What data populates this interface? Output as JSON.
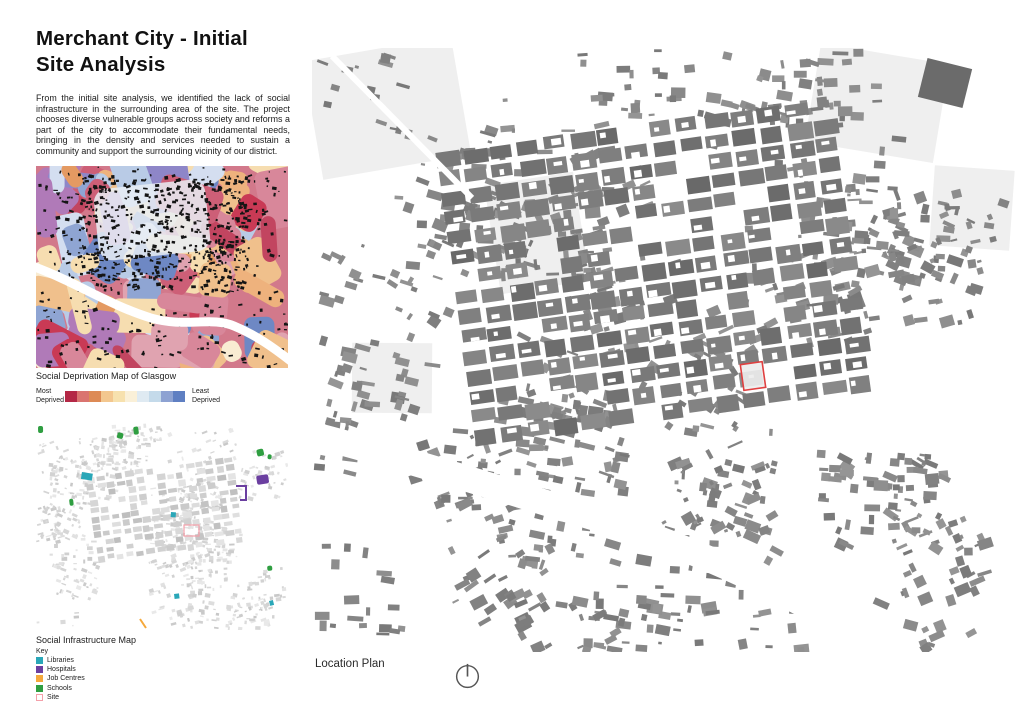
{
  "header": {
    "title": "Merchant City - Initial\nSite Analysis",
    "intro": "From the initial site analysis, we identified the lack of social infrastructure in the surrounding area of the site. The project chooses diverse vulnerable groups across society and reforms a part of the city to accommodate their fundamental needs, bringing in the density and services needed to sustain a community and support the surrounding vicinity of our district."
  },
  "deprivation_map": {
    "caption": "Social Deprivation Map of Glasgow",
    "legend": {
      "left_label": "Most\nDeprived",
      "right_label": "Least\nDeprived",
      "colors": [
        "#b42846",
        "#da7470",
        "#dd8a55",
        "#f3c78f",
        "#f7e1ae",
        "#faf0d8",
        "#dfeaf2",
        "#c4daea",
        "#8da2d2",
        "#5f7fc2"
      ]
    }
  },
  "infrastructure_map": {
    "caption": "Social Infrastructure Map",
    "key_title": "Key",
    "key": [
      {
        "type": "library",
        "label": "Libraries",
        "color": "#2aa7b8",
        "filled": true
      },
      {
        "type": "hospital",
        "label": "Hospitals",
        "color": "#6b3fa0",
        "filled": true
      },
      {
        "type": "jobcentre",
        "label": "Job Centres",
        "color": "#f5a93c",
        "filled": true
      },
      {
        "type": "school",
        "label": "Schools",
        "color": "#2f9e41",
        "filled": true
      },
      {
        "type": "site",
        "label": "Site",
        "color": "#f4a0aa",
        "filled": false
      }
    ],
    "markers": [
      {
        "type": "school",
        "shape": "blob",
        "x": 2,
        "y": 6,
        "w": 5,
        "h": 7
      },
      {
        "type": "school",
        "shape": "blob",
        "x": 82,
        "y": 12,
        "w": 6,
        "h": 6
      },
      {
        "type": "school",
        "shape": "blob",
        "x": 97,
        "y": 7,
        "w": 5,
        "h": 8
      },
      {
        "type": "school",
        "shape": "blob",
        "x": 220,
        "y": 30,
        "w": 7,
        "h": 7
      },
      {
        "type": "school",
        "shape": "blob",
        "x": 232,
        "y": 34,
        "w": 4,
        "h": 5
      },
      {
        "type": "school",
        "shape": "blob",
        "x": 33,
        "y": 79,
        "w": 4,
        "h": 7
      },
      {
        "type": "library",
        "shape": "rect",
        "x": 46,
        "y": 52,
        "w": 11,
        "h": 7
      },
      {
        "type": "hospital",
        "shape": "blob",
        "x": 220,
        "y": 56,
        "w": 12,
        "h": 9
      },
      {
        "type": "hospital",
        "shape": "outline",
        "x": 200,
        "y": 66,
        "w": 10,
        "h": 14
      },
      {
        "type": "library",
        "shape": "rect",
        "x": 135,
        "y": 92,
        "w": 5,
        "h": 5
      },
      {
        "type": "site",
        "shape": "outline-rect",
        "x": 148,
        "y": 105,
        "w": 15,
        "h": 11
      },
      {
        "type": "school",
        "shape": "blob",
        "x": 231,
        "y": 146,
        "w": 5,
        "h": 5
      },
      {
        "type": "library",
        "shape": "rect",
        "x": 138,
        "y": 174,
        "w": 5,
        "h": 5
      },
      {
        "type": "library",
        "shape": "rect",
        "x": 233,
        "y": 181,
        "w": 4,
        "h": 5
      },
      {
        "type": "jobcentre",
        "shape": "line",
        "x": 104,
        "y": 199,
        "w": 6,
        "h": 9
      }
    ]
  },
  "location_plan": {
    "caption": "Location Plan",
    "site_color": "#e04040",
    "building_color": "#7f7f7f",
    "site": {
      "x": 430,
      "y": 315,
      "w": 22,
      "h": 26,
      "angle": -8
    }
  }
}
